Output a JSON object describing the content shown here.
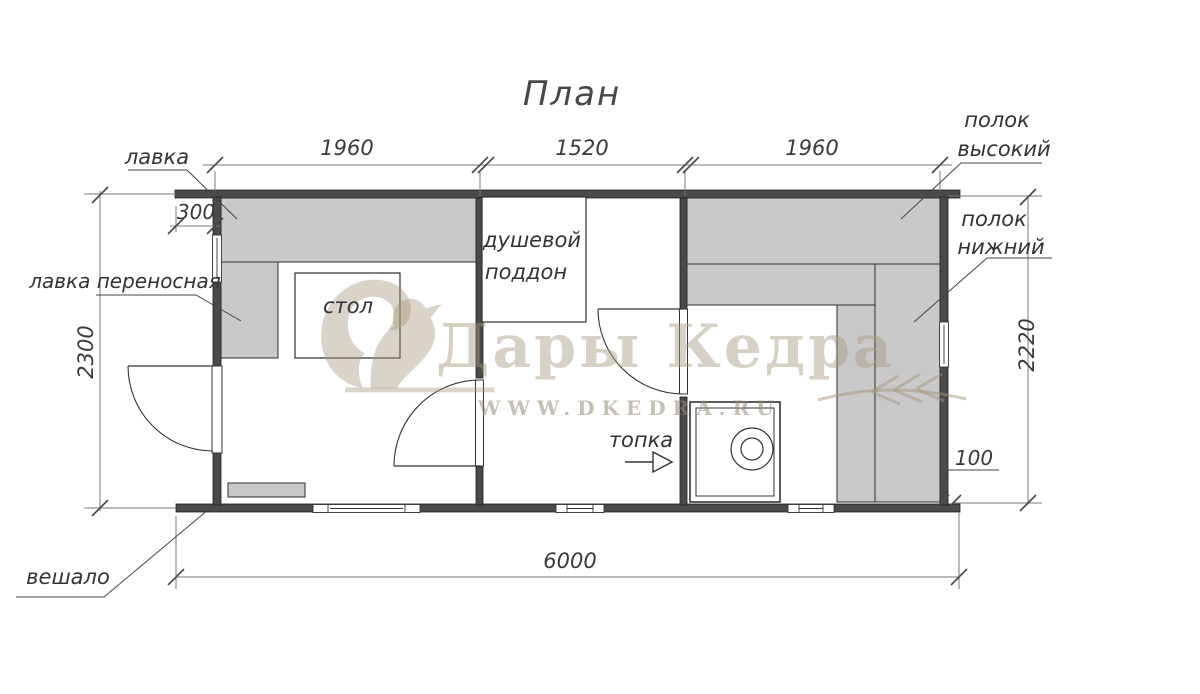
{
  "title": "План",
  "dimensions": {
    "top_segment_1": "1960",
    "top_segment_2": "1520",
    "top_segment_3": "1960",
    "left_width": "2300",
    "right_width": "2220",
    "total_length": "6000",
    "porch_depth": "300",
    "wall_thickness": "100"
  },
  "labels": {
    "bench": "лавка",
    "portable_bench": "лавка переносная",
    "table": "стол",
    "shower_line1": "душевой",
    "shower_line2": "поддон",
    "firebox": "топка",
    "hanger": "вешало",
    "shelf_high_line1": "полок",
    "shelf_high_line2": "высокий",
    "shelf_low_line1": "полок",
    "shelf_low_line2": "нижний"
  },
  "watermark": {
    "brand": "Дары Кедра",
    "site": "WWW.DKEDRA.RU"
  },
  "colors": {
    "wall_fill": "#4a4a4a",
    "furniture_fill": "#c9c9c9",
    "line": "#555555",
    "text": "#3a3a3a",
    "watermark_beige": "#d3c9ba"
  }
}
